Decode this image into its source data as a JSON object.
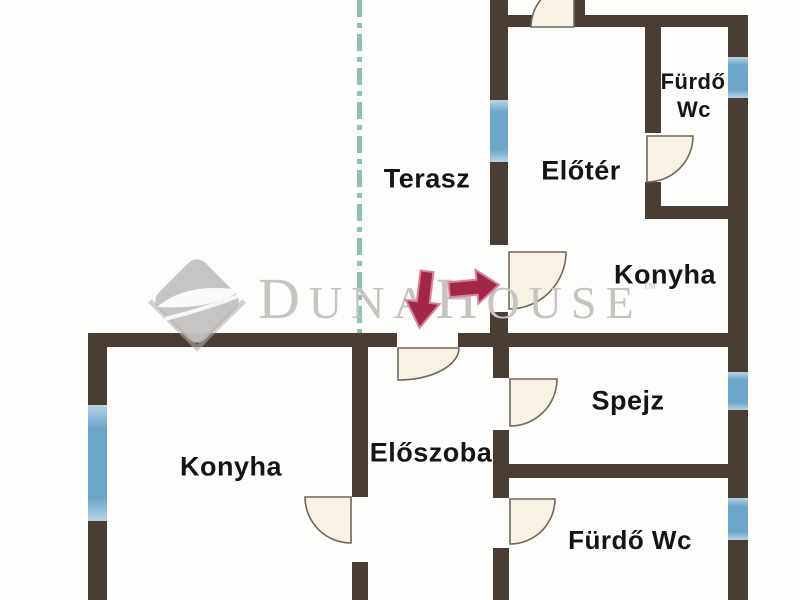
{
  "plan": {
    "type": "floor-plan",
    "rooms": [
      {
        "name": "terasz",
        "label": "Terasz"
      },
      {
        "name": "eloter",
        "label": "Előtér"
      },
      {
        "name": "furdo-wc-top-l1",
        "label": "Fürdő"
      },
      {
        "name": "furdo-wc-top-l2",
        "label": "Wc"
      },
      {
        "name": "konyha-right",
        "label": "Konyha"
      },
      {
        "name": "spejz",
        "label": "Spejz"
      },
      {
        "name": "konyha-left",
        "label": "Konyha"
      },
      {
        "name": "eloszoba",
        "label": "Előszoba"
      },
      {
        "name": "furdo-wc-bottom",
        "label": "Fürdő Wc"
      }
    ]
  },
  "watermark": {
    "brand_full": "DunaHouse™",
    "part1": "D",
    "part2": "UNA",
    "part3": "H",
    "part4": "OUSE",
    "trademark": "™"
  },
  "colors": {
    "wall": "#4a3e34",
    "window": "#6ca6c9",
    "window_light": "#b7d4e4",
    "terrace_line": "#8dbfb2",
    "door_fill": "#f8f2e4",
    "door_stroke": "#6f675c",
    "arrow": "#a22746",
    "arrow_outline": "#d7839b",
    "watermark_gray": "#c6c3c1",
    "label_text": "#151515",
    "background": "#fdfdfc"
  }
}
